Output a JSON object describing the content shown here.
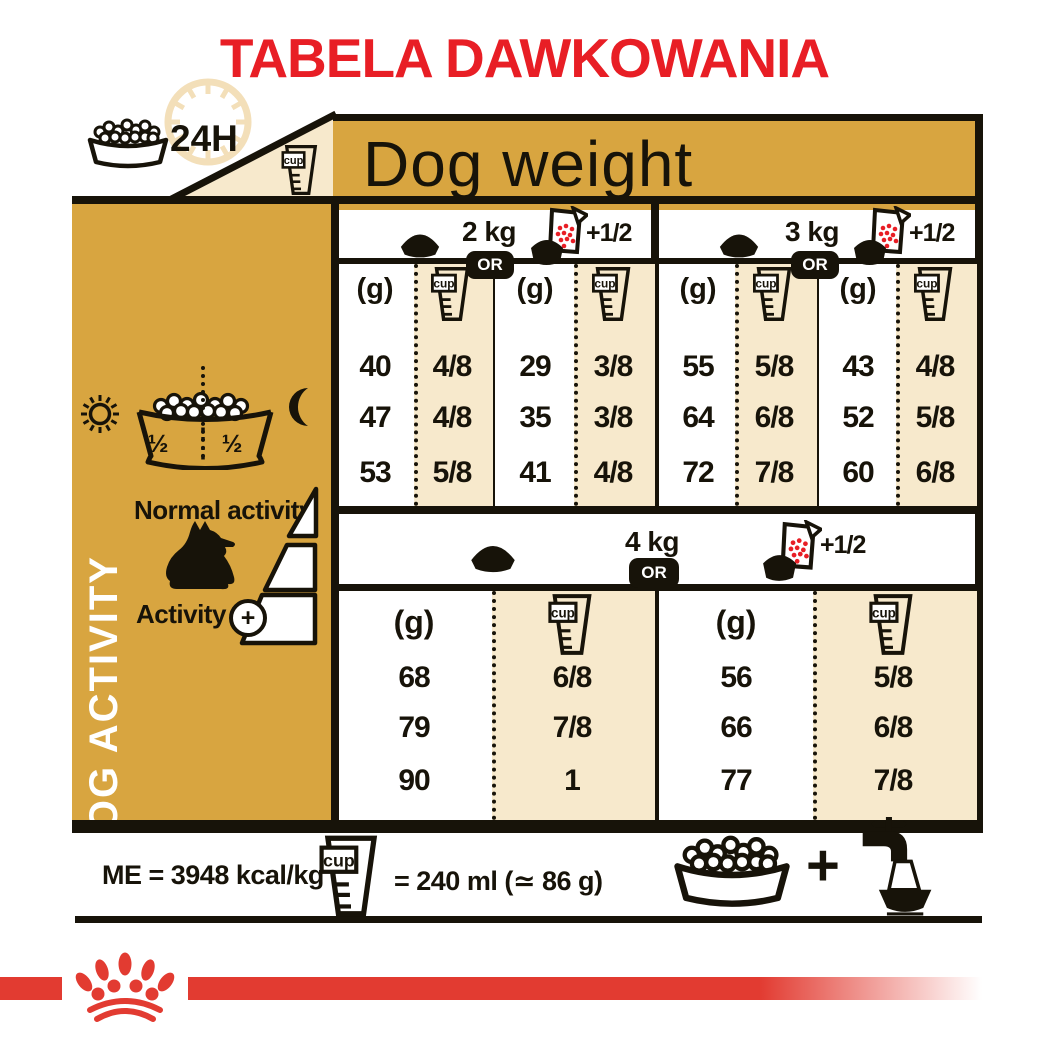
{
  "title": "TABELA DAWKOWANIA",
  "header": {
    "banner_label": "Dog weight",
    "clock_label": "24H"
  },
  "units": {
    "grams_label": "(g)",
    "cup_label": "cup"
  },
  "badges": {
    "or_label": "OR",
    "plus_half_label": "+1/2"
  },
  "sidebar": {
    "vertical_label": "DOG ACTIVITY",
    "normal_activity_label": "Normal activity",
    "activity_label": "Activity",
    "activity_plus": "+",
    "bowl_half_left": "½",
    "bowl_half_right": "½"
  },
  "table": {
    "sections": [
      {
        "weight_label": "2 kg",
        "columns": [
          {
            "grams": [
              "40",
              "47",
              "53"
            ],
            "cups": [
              "4/8",
              "4/8",
              "5/8"
            ]
          },
          {
            "grams": [
              "29",
              "35",
              "41"
            ],
            "cups": [
              "3/8",
              "3/8",
              "4/8"
            ]
          }
        ]
      },
      {
        "weight_label": "3 kg",
        "columns": [
          {
            "grams": [
              "55",
              "64",
              "72"
            ],
            "cups": [
              "5/8",
              "6/8",
              "7/8"
            ]
          },
          {
            "grams": [
              "43",
              "52",
              "60"
            ],
            "cups": [
              "4/8",
              "5/8",
              "6/8"
            ]
          }
        ]
      },
      {
        "weight_label": "4 kg",
        "columns": [
          {
            "grams": [
              "68",
              "79",
              "90"
            ],
            "cups": [
              "6/8",
              "7/8",
              "1"
            ]
          },
          {
            "grams": [
              "56",
              "66",
              "77"
            ],
            "cups": [
              "5/8",
              "6/8",
              "7/8"
            ]
          }
        ]
      }
    ]
  },
  "footer": {
    "me_label": "ME = 3948 kcal/kg",
    "cup_equivalence_label": "= 240 ml (≃ 86 g)",
    "plus_label": "+"
  },
  "colors": {
    "gold": "#d8a540",
    "cream": "#f7e9cc",
    "pale_clock": "#f3dfb9",
    "title_red": "#e81e25",
    "brand_red": "#e23b31",
    "ink_black": "#171309"
  }
}
